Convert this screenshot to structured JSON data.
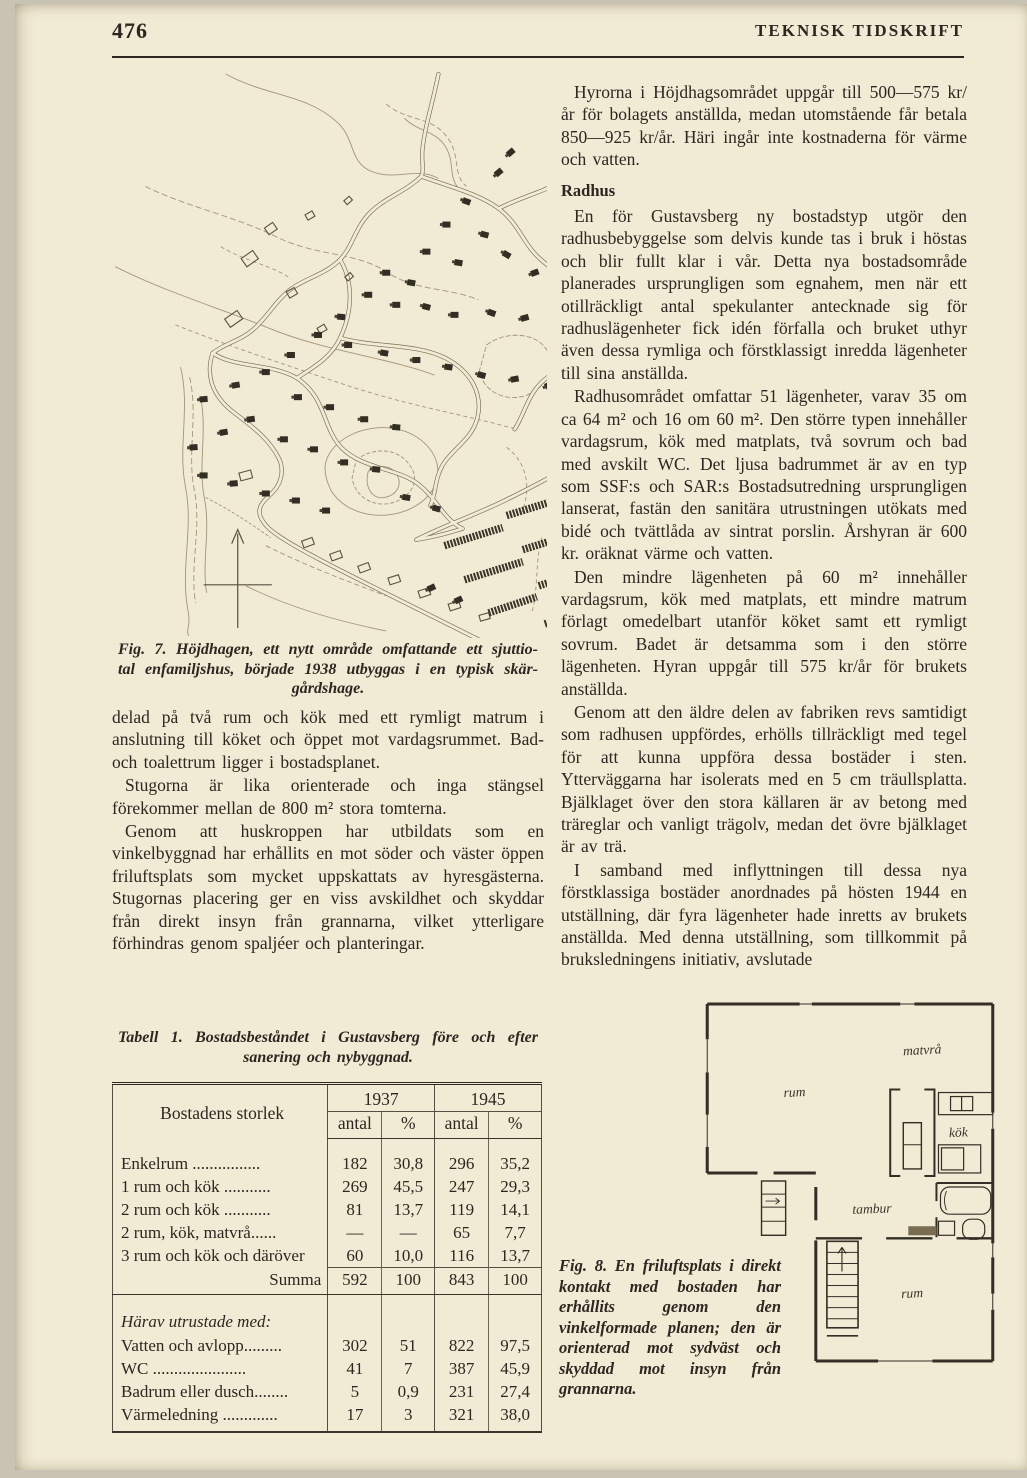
{
  "header": {
    "page_number": "476",
    "journal_title": "TEKNISK TIDSKRIFT"
  },
  "right_column": {
    "p1": "Hyrorna i Höjdhagsområdet uppgår till 500—575 kr/år för bolagets anställda, medan utomstående får betala 850—925 kr/år. Häri ingår inte kostnaderna för värme och vatten.",
    "heading": "Radhus",
    "p2": "En för Gustavsberg ny bostadstyp utgör den radhusbebyggelse som delvis kunde tas i bruk i höstas och blir fullt klar i vår. Detta nya bostadsområde planerades ursprungligen som egnahem, men när ett otillräckligt antal spekulanter antecknade sig för radhuslägenheter fick idén förfalla och bruket uthyr även dessa rymliga och förstklassigt inredda lägenheter till sina anställda.",
    "p3": "Radhusområdet omfattar 51 lägenheter, varav 35 om ca 64 m² och 16 om 60 m². Den större typen innehåller vardagsrum, kök med matplats, två sovrum och bad med avskilt WC. Det ljusa badrummet är av en typ som SSF:s och SAR:s Bostadsutredning ursprungligen lanserat, fastän den sanitära utrustningen utökats med bidé och tvättlåda av sintrat porslin. Årshyran är 600 kr. oräknat värme och vatten.",
    "p4": "Den mindre lägenheten på 60 m² innehåller vardagsrum, kök med matplats, ett mindre matrum förlagt omedelbart utanför köket samt ett rymligt sovrum. Badet är detsamma som i den större lägenheten. Hyran uppgår till 575 kr/år för brukets anställda.",
    "p5": "Genom att den äldre delen av fabriken revs samtidigt som radhusen uppfördes, erhölls tillräckligt med tegel för att kunna uppföra dessa bostäder i sten. Ytterväggarna har isolerats med en 5 cm träullsplatta. Bjälklaget över den stora källaren är av betong med träreglar och vanligt trägolv, medan det övre bjälklaget är av trä.",
    "p6": "I samband med inflyttningen till dessa nya förstklassiga bostäder anordnades på hösten 1944 en utställning, där fyra lägenheter hade inretts av brukets anställda. Med denna utställning, som tillkommit på bruksledningens initiativ, avslutade"
  },
  "left_column": {
    "p1": "delad på två rum och kök med ett rymligt matrum i anslutning till köket och öppet mot vardagsrummet. Bad- och toalettrum ligger i bostadsplanet.",
    "p2": "Stugorna är lika orienterade och inga stängsel förekommer mellan de 800 m² stora tomterna.",
    "p3": "Genom att huskroppen har utbildats som en vinkelbyggnad har erhållits en mot söder och väster öppen friluftsplats som mycket uppskattats av hyresgästerna. Stugornas placering ger en viss avskildhet och skyddar från direkt insyn från grannarna, vilket ytterligare förhindras genom spaljéer och planteringar."
  },
  "figures": {
    "fig7": {
      "lines": [
        "Fig. 7. Höjdhagen, ett nytt område omfattande ett sjuttio-",
        "tal enfamiljshus, började 1938 utbyggas i en typisk skär-",
        "gårdshage."
      ]
    },
    "fig8": {
      "caption": "Fig. 8. En friluftsplats i direkt kontakt med bostaden har erhållits genom den vinkelformade planen; den är orienterad mot sydväst och skyddad mot insyn från grannarna.",
      "labels": {
        "matvra": "matvrå",
        "rum_upper": "rum",
        "kok": "kök",
        "tambur": "tambur",
        "rum_lower": "rum"
      }
    }
  },
  "table": {
    "caption_lines": [
      "Tabell 1. Bostadsbeståndet i Gustavsberg före och efter",
      "sanering och nybyggnad."
    ],
    "col_label": "Bostadens storlek",
    "years": [
      "1937",
      "1945"
    ],
    "sub_headers": [
      "antal",
      "%",
      "antal",
      "%"
    ],
    "rows": [
      [
        "Enkelrum ................",
        "182",
        "30,8",
        "296",
        "35,2"
      ],
      [
        "1 rum och kök ...........",
        "269",
        "45,5",
        "247",
        "29,3"
      ],
      [
        "2 rum och kök ...........",
        "81",
        "13,7",
        "119",
        "14,1"
      ],
      [
        "2 rum, kök, matvrå......",
        "—",
        "—",
        "65",
        "7,7"
      ],
      [
        "3 rum och kök och däröver",
        "60",
        "10,0",
        "116",
        "13,7"
      ]
    ],
    "summa": [
      "Summa",
      "592",
      "100",
      "843",
      "100"
    ],
    "section_label": "Härav utrustade med:",
    "equipment_rows": [
      [
        "Vatten och avlopp.........",
        "302",
        "51",
        "822",
        "97,5"
      ],
      [
        "WC ......................",
        "41",
        "7",
        "387",
        "45,9"
      ],
      [
        "Badrum eller dusch........",
        "5",
        "0,9",
        "231",
        "27,4"
      ],
      [
        "Värmeledning .............",
        "17",
        "3",
        "321",
        "38,0"
      ]
    ]
  },
  "colors": {
    "paper": "#f1ead4",
    "ink": "#2c2720",
    "contour": "#a3957a"
  }
}
